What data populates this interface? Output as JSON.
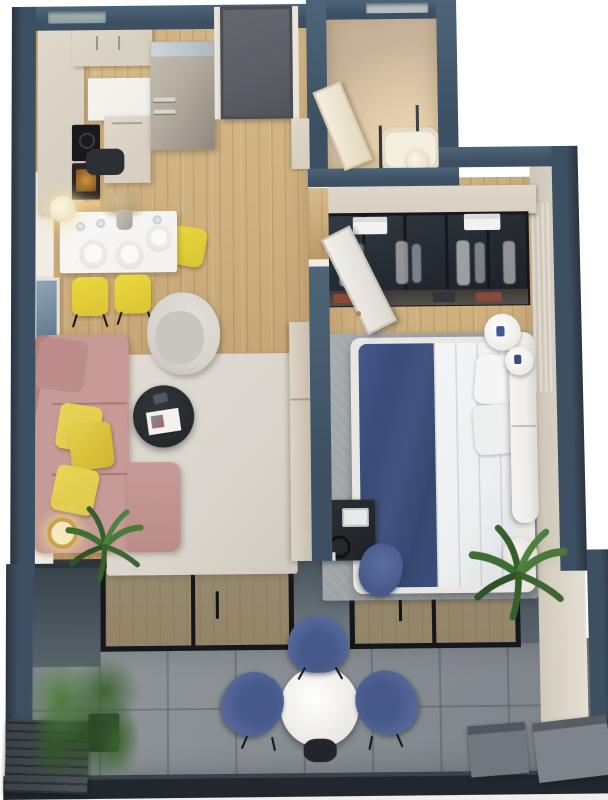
{
  "title": "3D top-down render of a one-bedroom apartment floor plan with balcony",
  "view": "bird's-eye 3D architectural visualization, no text labels",
  "palette": {
    "wall": "#3d5063",
    "wall-hi": "#4e6579",
    "wall-dark": "#2a3540",
    "inner-wall": "#f1ede6",
    "wood": "#c9a978",
    "wood-hi": "#d8bc8c",
    "wood-lo": "#bb9766",
    "bath-floor": "#cfbaa0",
    "bath-glow": "#ecd5ae",
    "tile": "#878d92",
    "rug-living": "#dad6cd",
    "rug-bedroom": "#9aa1a4",
    "sofa": "#c69a96",
    "sofa-dark": "#b2817e",
    "pillow-yellow": "#dfca49",
    "chair-yellow": "#ecd83f",
    "armchair": "#d7d3cd",
    "table-white": "#f3f2ef",
    "coffee-table": "#25292c",
    "cream": "#d7cfc1",
    "counter-white": "#efede7",
    "steel": "#b3aca0",
    "steel-dark": "#8f887c",
    "door-gray": "#5c5f65",
    "bed-white": "#edeff0",
    "bed-navy": "#3d4e7c",
    "headboard": "#efeeeb",
    "wardrobe-glass": "#262c33",
    "wardrobe-frame": "#14181d",
    "balcony-chair": "#54689a",
    "balcony-chair-dark": "#47598b",
    "plant": "#4e7c3b",
    "plant-dark": "#2f5226",
    "rail": "#21272c",
    "outer-face": "#edeff1",
    "stub-gray": "#7d868d"
  },
  "scene": {
    "rooms": [
      {
        "name": "kitchen-dining",
        "floor": "light oak",
        "items": [
          "cream L-shaped cabinets",
          "stainless refrigerator",
          "black cooktop",
          "oven with warm light",
          "white dining table with 3 plates and glasses",
          "vase with pampas grass",
          "3 yellow chairs",
          "1 dark chair",
          "pendant lamp"
        ]
      },
      {
        "name": "entrance-hall",
        "items": [
          "dark gray front door",
          "cream hall cabinet"
        ]
      },
      {
        "name": "bathroom",
        "floor": "beige tile",
        "items": [
          "white open door",
          "bathtub with glass screen",
          "round stool",
          "window slit"
        ]
      },
      {
        "name": "living-room",
        "floor": "light oak",
        "items": [
          "pink L-shaped sofa",
          "3 yellow pillows",
          "light rug",
          "dark round coffee table with magazine",
          "gray armchair",
          "beige TV cabinet",
          "wall art frames",
          "floor lamp",
          "palm plant"
        ]
      },
      {
        "name": "bedroom",
        "floor": "light oak",
        "items": [
          "glass-front wardrobe with white clothes and towels",
          "white open door",
          "double bed with navy throw and white duvet",
          "white headboard",
          "2 white pillows",
          "gray rug",
          "2 round white side tables",
          "dark desk with laptop and headphones",
          "blue desk chair",
          "palm in white pot"
        ]
      },
      {
        "name": "balcony",
        "floor": "gray stone tile",
        "items": [
          "2 glass sliding doors",
          "white round bistro table",
          "3 blue chairs",
          "green shrub in slatted planter",
          "gray utility boxes",
          "dark railing"
        ]
      }
    ]
  }
}
